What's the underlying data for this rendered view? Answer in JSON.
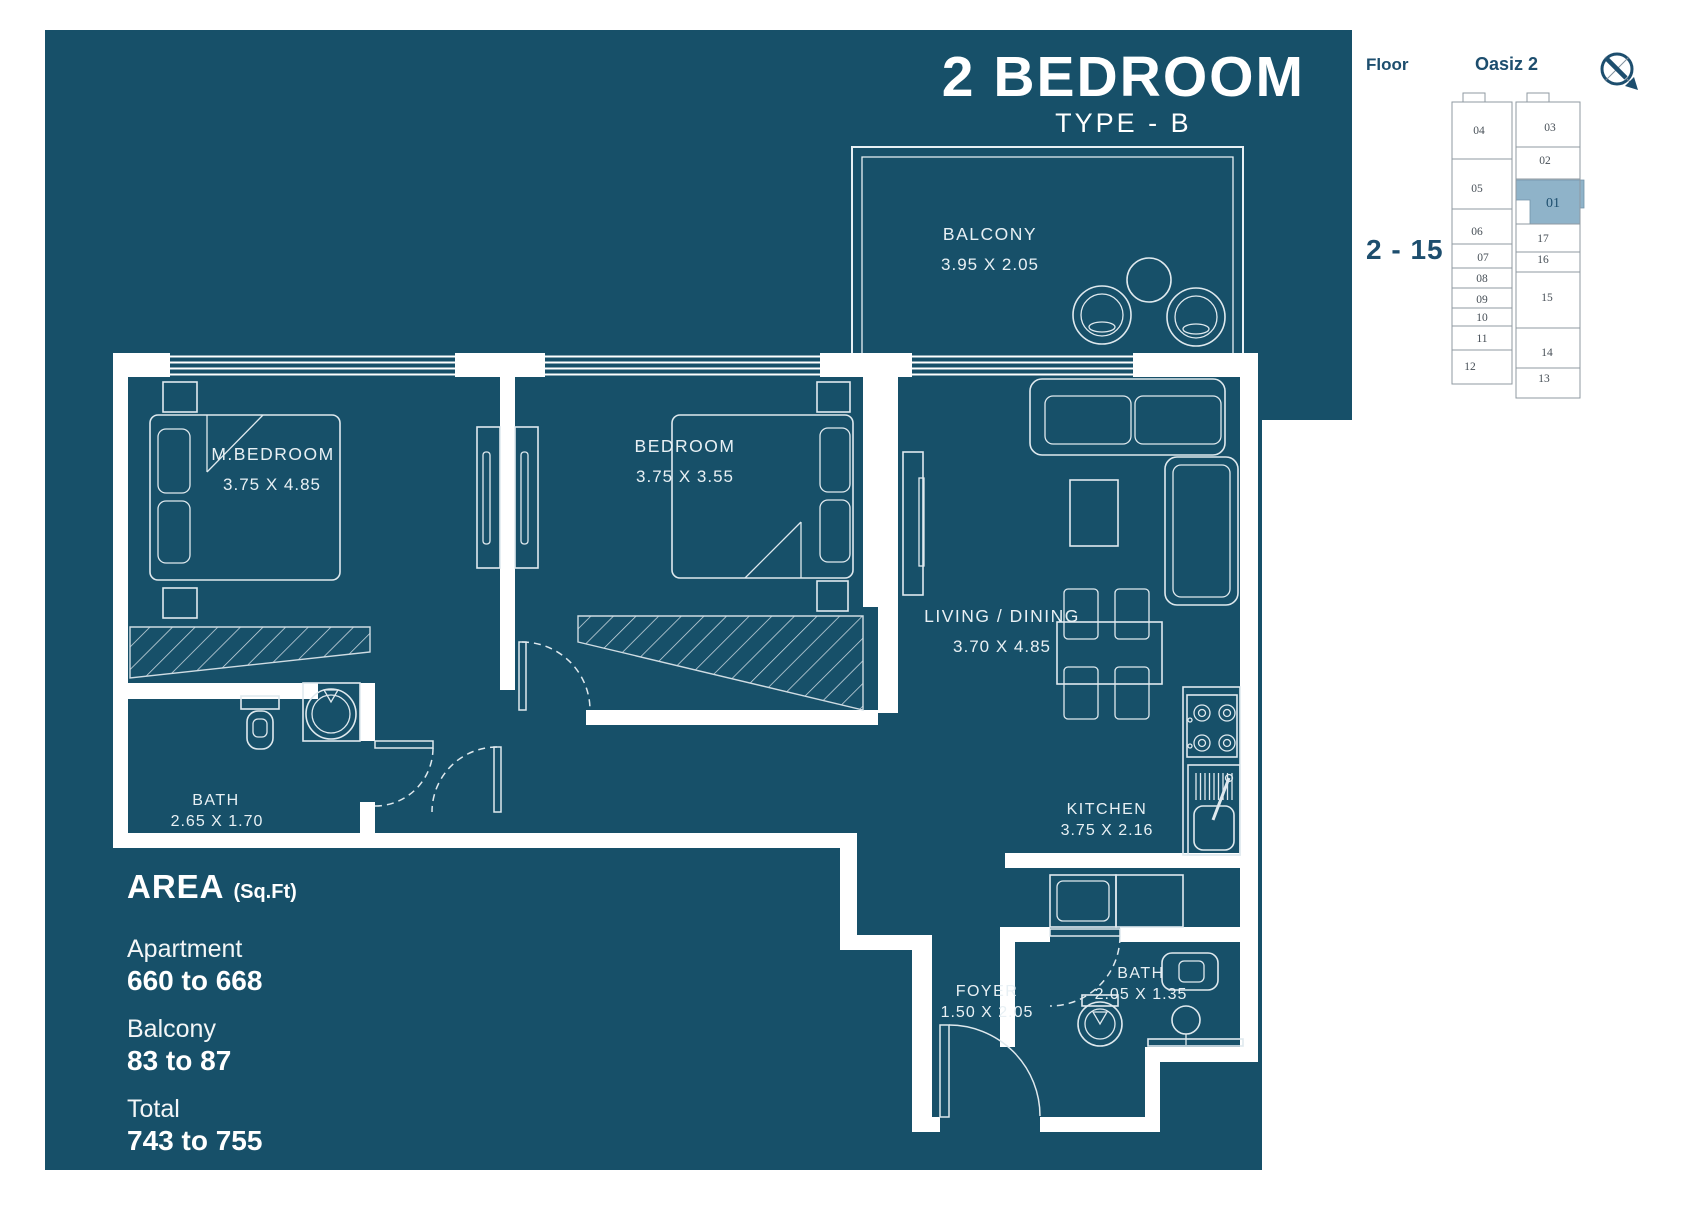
{
  "title": {
    "main": "2 BEDROOM",
    "sub": "TYPE - B"
  },
  "header": {
    "floor_label": "Floor",
    "project_name": "Oasiz 2",
    "floor_range": "2 - 15"
  },
  "rooms": {
    "balcony": {
      "name": "BALCONY",
      "dims": "3.95 X 2.05"
    },
    "master_bedroom": {
      "name": "M.BEDROOM",
      "dims": "3.75 X 4.85"
    },
    "bedroom": {
      "name": "BEDROOM",
      "dims": "3.75 X 3.55"
    },
    "living": {
      "name": "LIVING / DINING",
      "dims": "3.70 X 4.85"
    },
    "bath1": {
      "name": "BATH",
      "dims": "2.65 X 1.70"
    },
    "kitchen": {
      "name": "KITCHEN",
      "dims": "3.75 X 2.16"
    },
    "foyer": {
      "name": "FOYER",
      "dims": "1.50 X 2.05"
    },
    "bath2": {
      "name": "BATH",
      "dims": "2.05 X 1.35"
    }
  },
  "area": {
    "heading": "AREA",
    "heading_unit": "(Sq.Ft)",
    "items": [
      {
        "label": "Apartment",
        "value": "660 to 668"
      },
      {
        "label": "Balcony",
        "value": "83 to 87"
      },
      {
        "label": "Total",
        "value": "743 to 755"
      }
    ]
  },
  "keyplan": {
    "highlighted_unit": "01",
    "units_left": [
      "04",
      "05",
      "06",
      "07",
      "08",
      "09",
      "10",
      "11",
      "12"
    ],
    "units_right": [
      "03",
      "02",
      "01",
      "17",
      "16",
      "15",
      "14",
      "13"
    ]
  },
  "colors": {
    "panel_bg": "#175069",
    "accent_navy": "#1d4e6e",
    "highlight_unit": "#8fb3c9",
    "plan_line": "#dfe9ee"
  }
}
